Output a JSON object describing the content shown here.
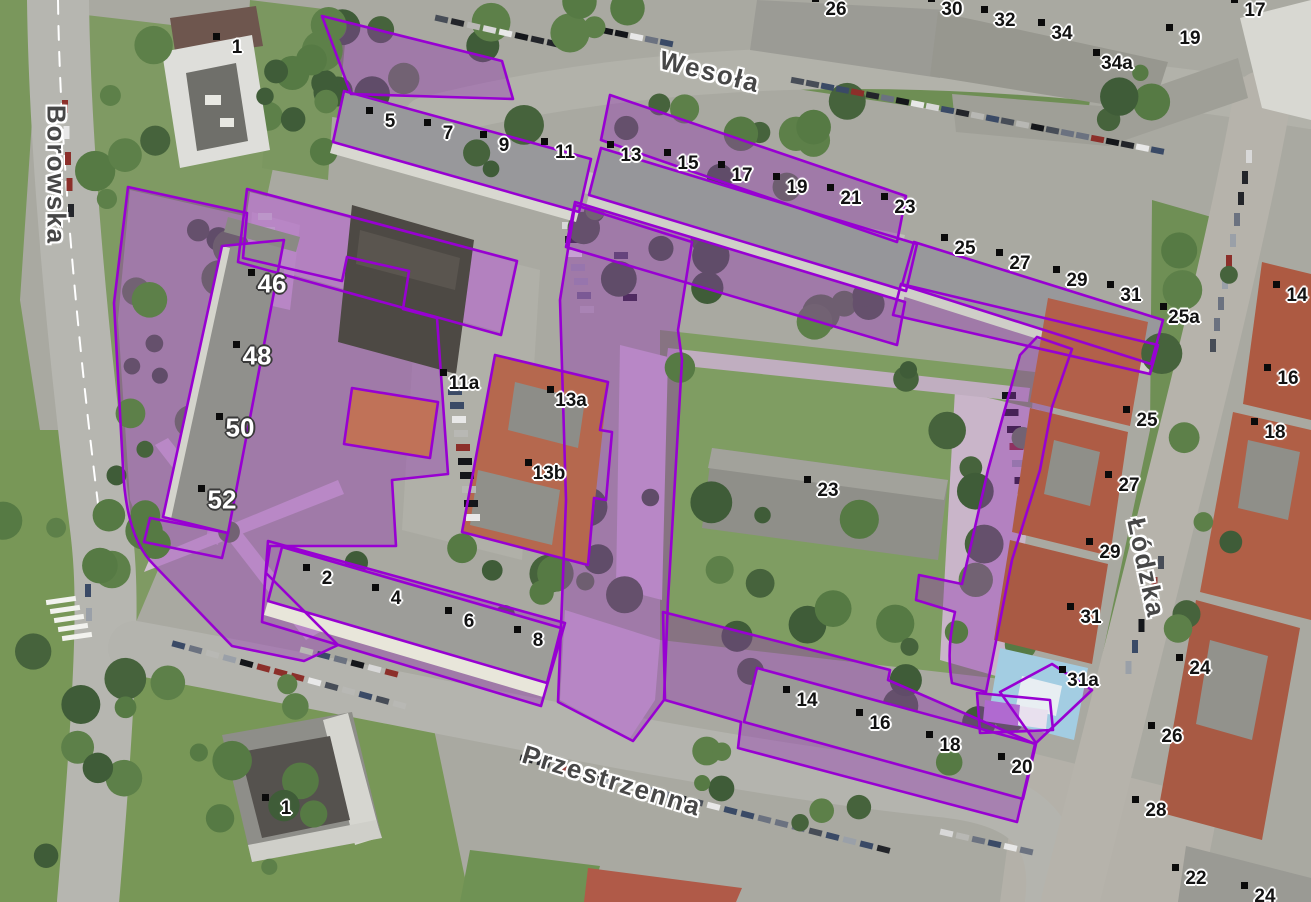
{
  "map": {
    "overlay_color": "#9800D2",
    "street_labels": [
      {
        "name": "Borowska",
        "x": 56,
        "y": 175,
        "rot": 90
      },
      {
        "name": "Wesoła",
        "x": 710,
        "y": 72,
        "rot": 14
      },
      {
        "name": "Łódzka",
        "x": 1146,
        "y": 568,
        "rot": 78
      },
      {
        "name": "Przestrzenna",
        "x": 612,
        "y": 781,
        "rot": 17
      }
    ],
    "address_labels": [
      {
        "t": "1",
        "x": 237,
        "y": 48
      },
      {
        "t": "5",
        "x": 390,
        "y": 122
      },
      {
        "t": "7",
        "x": 448,
        "y": 134
      },
      {
        "t": "9",
        "x": 504,
        "y": 146
      },
      {
        "t": "11",
        "x": 565,
        "y": 153
      },
      {
        "t": "13",
        "x": 631,
        "y": 156
      },
      {
        "t": "15",
        "x": 688,
        "y": 164
      },
      {
        "t": "17",
        "x": 742,
        "y": 176
      },
      {
        "t": "19",
        "x": 797,
        "y": 188
      },
      {
        "t": "21",
        "x": 851,
        "y": 199
      },
      {
        "t": "23",
        "x": 905,
        "y": 208
      },
      {
        "t": "25",
        "x": 965,
        "y": 249
      },
      {
        "t": "27",
        "x": 1020,
        "y": 264
      },
      {
        "t": "29",
        "x": 1077,
        "y": 281
      },
      {
        "t": "31",
        "x": 1131,
        "y": 296
      },
      {
        "t": "25a",
        "x": 1184,
        "y": 318
      },
      {
        "t": "26",
        "x": 836,
        "y": 10
      },
      {
        "t": "30",
        "x": 952,
        "y": 10
      },
      {
        "t": "32",
        "x": 1005,
        "y": 21
      },
      {
        "t": "34",
        "x": 1062,
        "y": 34
      },
      {
        "t": "34a",
        "x": 1117,
        "y": 64
      },
      {
        "t": "19",
        "x": 1190,
        "y": 39
      },
      {
        "t": "17",
        "x": 1255,
        "y": 11
      },
      {
        "t": "14",
        "x": 1297,
        "y": 296
      },
      {
        "t": "16",
        "x": 1288,
        "y": 379
      },
      {
        "t": "18",
        "x": 1275,
        "y": 433
      },
      {
        "t": "25",
        "x": 1147,
        "y": 421
      },
      {
        "t": "27",
        "x": 1129,
        "y": 486
      },
      {
        "t": "29",
        "x": 1110,
        "y": 553
      },
      {
        "t": "31",
        "x": 1091,
        "y": 618
      },
      {
        "t": "31a",
        "x": 1083,
        "y": 681
      },
      {
        "t": "24",
        "x": 1200,
        "y": 669
      },
      {
        "t": "26",
        "x": 1172,
        "y": 737
      },
      {
        "t": "28",
        "x": 1156,
        "y": 811
      },
      {
        "t": "22",
        "x": 1196,
        "y": 879
      },
      {
        "t": "24",
        "x": 1265,
        "y": 897
      },
      {
        "t": "11a",
        "x": 464,
        "y": 384
      },
      {
        "t": "13a",
        "x": 571,
        "y": 401
      },
      {
        "t": "13b",
        "x": 549,
        "y": 474
      },
      {
        "t": "23",
        "x": 828,
        "y": 491
      },
      {
        "t": "2",
        "x": 327,
        "y": 579
      },
      {
        "t": "4",
        "x": 396,
        "y": 599
      },
      {
        "t": "6",
        "x": 469,
        "y": 622
      },
      {
        "t": "8",
        "x": 538,
        "y": 641
      },
      {
        "t": "14",
        "x": 807,
        "y": 701
      },
      {
        "t": "16",
        "x": 880,
        "y": 724
      },
      {
        "t": "18",
        "x": 950,
        "y": 746
      },
      {
        "t": "20",
        "x": 1022,
        "y": 768
      },
      {
        "t": "1",
        "x": 286,
        "y": 809
      },
      {
        "t": "46",
        "x": 272,
        "y": 284,
        "w": 1
      },
      {
        "t": "48",
        "x": 257,
        "y": 356,
        "w": 1
      },
      {
        "t": "50",
        "x": 240,
        "y": 428,
        "w": 1
      },
      {
        "t": "52",
        "x": 222,
        "y": 500,
        "w": 1
      }
    ]
  }
}
